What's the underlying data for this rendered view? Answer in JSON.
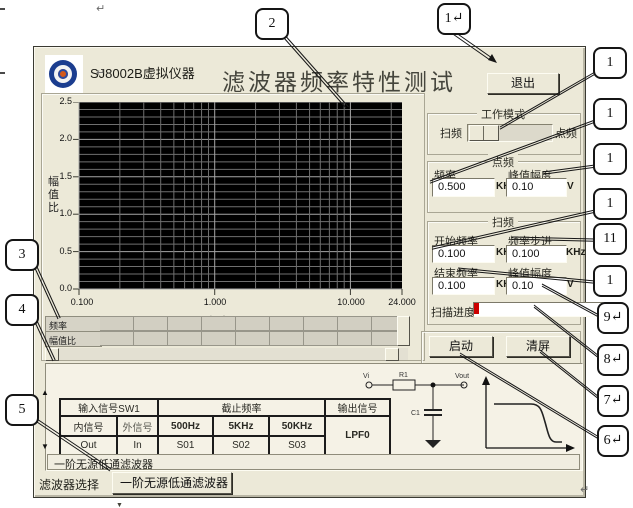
{
  "page": {
    "return_mark": "↵",
    "dash_mark": ""
  },
  "window": {
    "brand": "SJ8002B虚拟仪器",
    "title": "滤波器频率特性测试",
    "exit_label": "退出"
  },
  "chart": {
    "type": "line",
    "series": [],
    "ylabel": "幅值比",
    "xlabel": "频率（KHz）",
    "y_ticks": [
      "2.5",
      "2.0",
      "1.5",
      "1.0",
      "0.5",
      "0.0"
    ],
    "x_ticks": [
      "0.100",
      "1.000",
      "10.000",
      "24.000"
    ],
    "x_min": 0.1,
    "x_max": 24,
    "y_min": 0,
    "y_max": 2.5,
    "y_minor_step": 0.1,
    "y_major_step": 0.5,
    "plot_bg": "#000000",
    "grid_minor": "#6f6f6f",
    "grid_major": "#a6a6a6"
  },
  "readout": {
    "rows": [
      "频率",
      "幅值比"
    ]
  },
  "mode": {
    "title": "工作模式",
    "left": "扫频",
    "right": "点频"
  },
  "point": {
    "title": "点频",
    "f_label": "频率",
    "f_value": "0.500",
    "f_unit": "KHz",
    "a_label": "峰值幅度",
    "a_value": "0.10",
    "a_unit": "V"
  },
  "sweep": {
    "title": "扫频",
    "start_label": "开始频率",
    "start_value": "0.100",
    "start_unit": "KHz",
    "step_label": "频率步进",
    "step_value": "0.100",
    "step_unit": "KHz",
    "end_label": "结束频率",
    "end_value": "0.100",
    "end_unit": "KHz",
    "amp_label": "峰值幅度",
    "amp_value": "0.10",
    "amp_unit": "V",
    "progress_label": "扫描进度",
    "progress_color": "#cc0000"
  },
  "actions": {
    "start": "启动",
    "clear": "清屏"
  },
  "filter_table": {
    "header_input": "输入信号SW1",
    "header_cutoff": "截止频率",
    "header_output": "输出信号",
    "sub_headers": [
      "内信号",
      "外信号",
      "500Hz",
      "5KHz",
      "50KHz"
    ],
    "output_value": "LPF0",
    "data_row": [
      "Out",
      "In",
      "S01",
      "S02",
      "S03"
    ]
  },
  "circuit": {
    "vi": "Vi",
    "r1": "R1",
    "vout": "Vout",
    "c1": "C1"
  },
  "status_text": "一阶无源低通滤波器",
  "selector": {
    "label": "滤波器选择",
    "value": "一阶无源低通滤波器",
    "arrow": "▼"
  },
  "callouts": {
    "top_chart": "2",
    "top_exit": "1↵",
    "left": [
      "3",
      "4",
      "5"
    ],
    "right": [
      "1",
      "1",
      "1",
      "1",
      "11",
      "1",
      "9↵",
      "8↵",
      "7↵",
      "6↵"
    ]
  }
}
